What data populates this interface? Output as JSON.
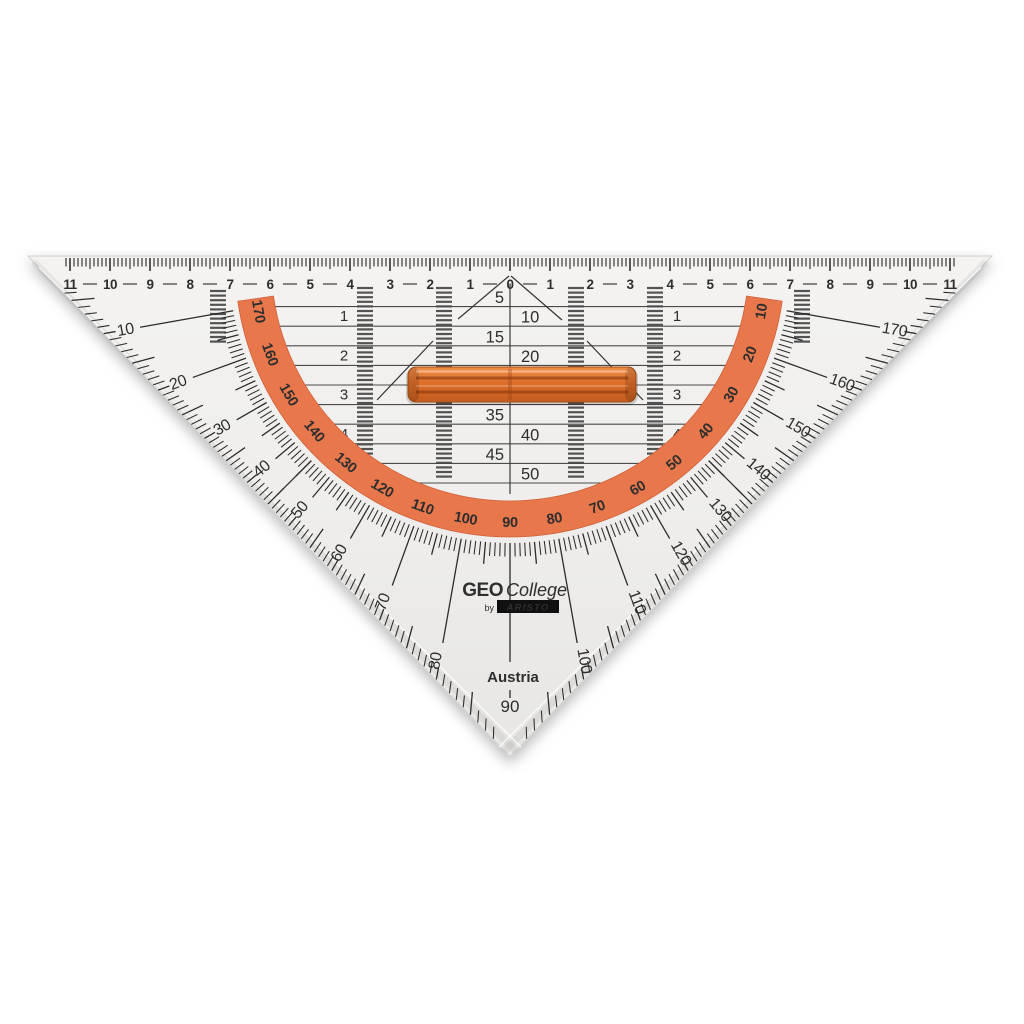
{
  "brand": {
    "geo": "GEO",
    "college": "College",
    "by": "by",
    "aristo": "ARISTO",
    "country": "Austria"
  },
  "colors": {
    "plastic": "#f2f1ef",
    "ink": "#2e2e2e",
    "band_orange": "#e8784c",
    "band_number_red": "#9c2b1a",
    "handle_orange": "#d96b28",
    "grid_line": "#4a4a4a"
  },
  "top_ruler": {
    "numbers": [
      "11",
      "10",
      "9",
      "8",
      "7",
      "6",
      "5",
      "4",
      "3",
      "2",
      "1",
      "0",
      "1",
      "2",
      "3",
      "4",
      "5",
      "6",
      "7",
      "8",
      "9",
      "10",
      "11"
    ]
  },
  "grid": {
    "center_labels": [
      "5",
      "10",
      "15",
      "20",
      "25",
      "30",
      "35",
      "40",
      "45",
      "50"
    ],
    "row_labels_left": [
      "1",
      "2",
      "3",
      "4"
    ],
    "row_labels_right": [
      "1",
      "2",
      "3",
      "4"
    ]
  },
  "protractor": {
    "outer_numbers": [
      "10",
      "20",
      "30",
      "40",
      "50",
      "60",
      "70",
      "80",
      "90",
      "100",
      "110",
      "120",
      "130",
      "140",
      "150",
      "160",
      "170"
    ],
    "inner_numbers": [
      "170",
      "160",
      "150",
      "140",
      "130",
      "120",
      "110",
      "100",
      "90",
      "80",
      "70",
      "60",
      "50",
      "40",
      "30",
      "20",
      "10"
    ]
  }
}
